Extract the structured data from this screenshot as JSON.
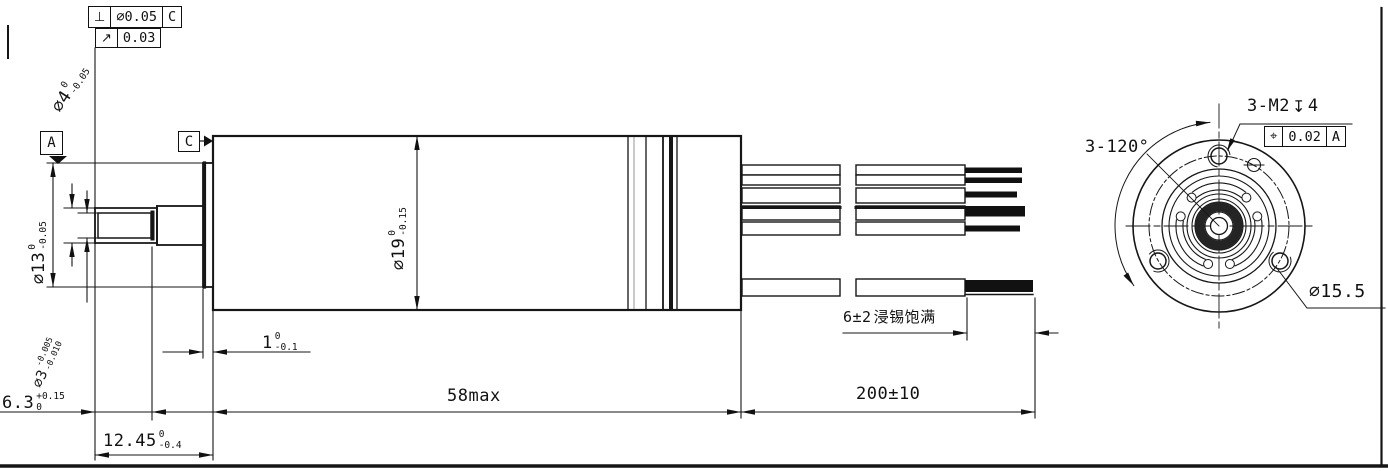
{
  "drawing": {
    "tolerance_frames": {
      "perpendicularity": {
        "symbol": "⊥",
        "value": "∅0.05",
        "datum": "C"
      },
      "runout": {
        "symbol": "↗",
        "value": "0.03"
      },
      "position": {
        "symbol": "⌖",
        "value": "0.02",
        "datum": "A"
      }
    },
    "datums": {
      "a": "A",
      "c": "C"
    },
    "dimensions": {
      "shaft_dia": {
        "value": "∅4",
        "upper": "0",
        "lower": "-0.05"
      },
      "pinion_dia": {
        "value": "∅3",
        "upper": "-0.005",
        "lower": "-0.010"
      },
      "hub_dia": {
        "value": "∅13",
        "upper": "0",
        "lower": "-0.05"
      },
      "body_dia": {
        "value": "∅19",
        "upper": "0",
        "lower": "-0.15"
      },
      "pilot_len": {
        "value": "1",
        "upper": "0",
        "lower": "-0.1"
      },
      "pinion_len": {
        "value": "6.3",
        "upper": "+0.15",
        "lower": "0"
      },
      "shaft_len": {
        "value": "12.45",
        "upper": "0",
        "lower": "-0.4"
      },
      "body_len": {
        "value": "58max"
      },
      "lead_len": {
        "value": "200±10"
      },
      "tinned_len": {
        "value": "6±2",
        "note": "浸锡饱满"
      },
      "mount_circle_dia": {
        "value": "∅15.5"
      },
      "hole_spacing": {
        "value": "3-120°"
      },
      "thread_callout": {
        "prefix": "3-M2",
        "depth_symbol": "↧",
        "depth": "4"
      }
    }
  }
}
